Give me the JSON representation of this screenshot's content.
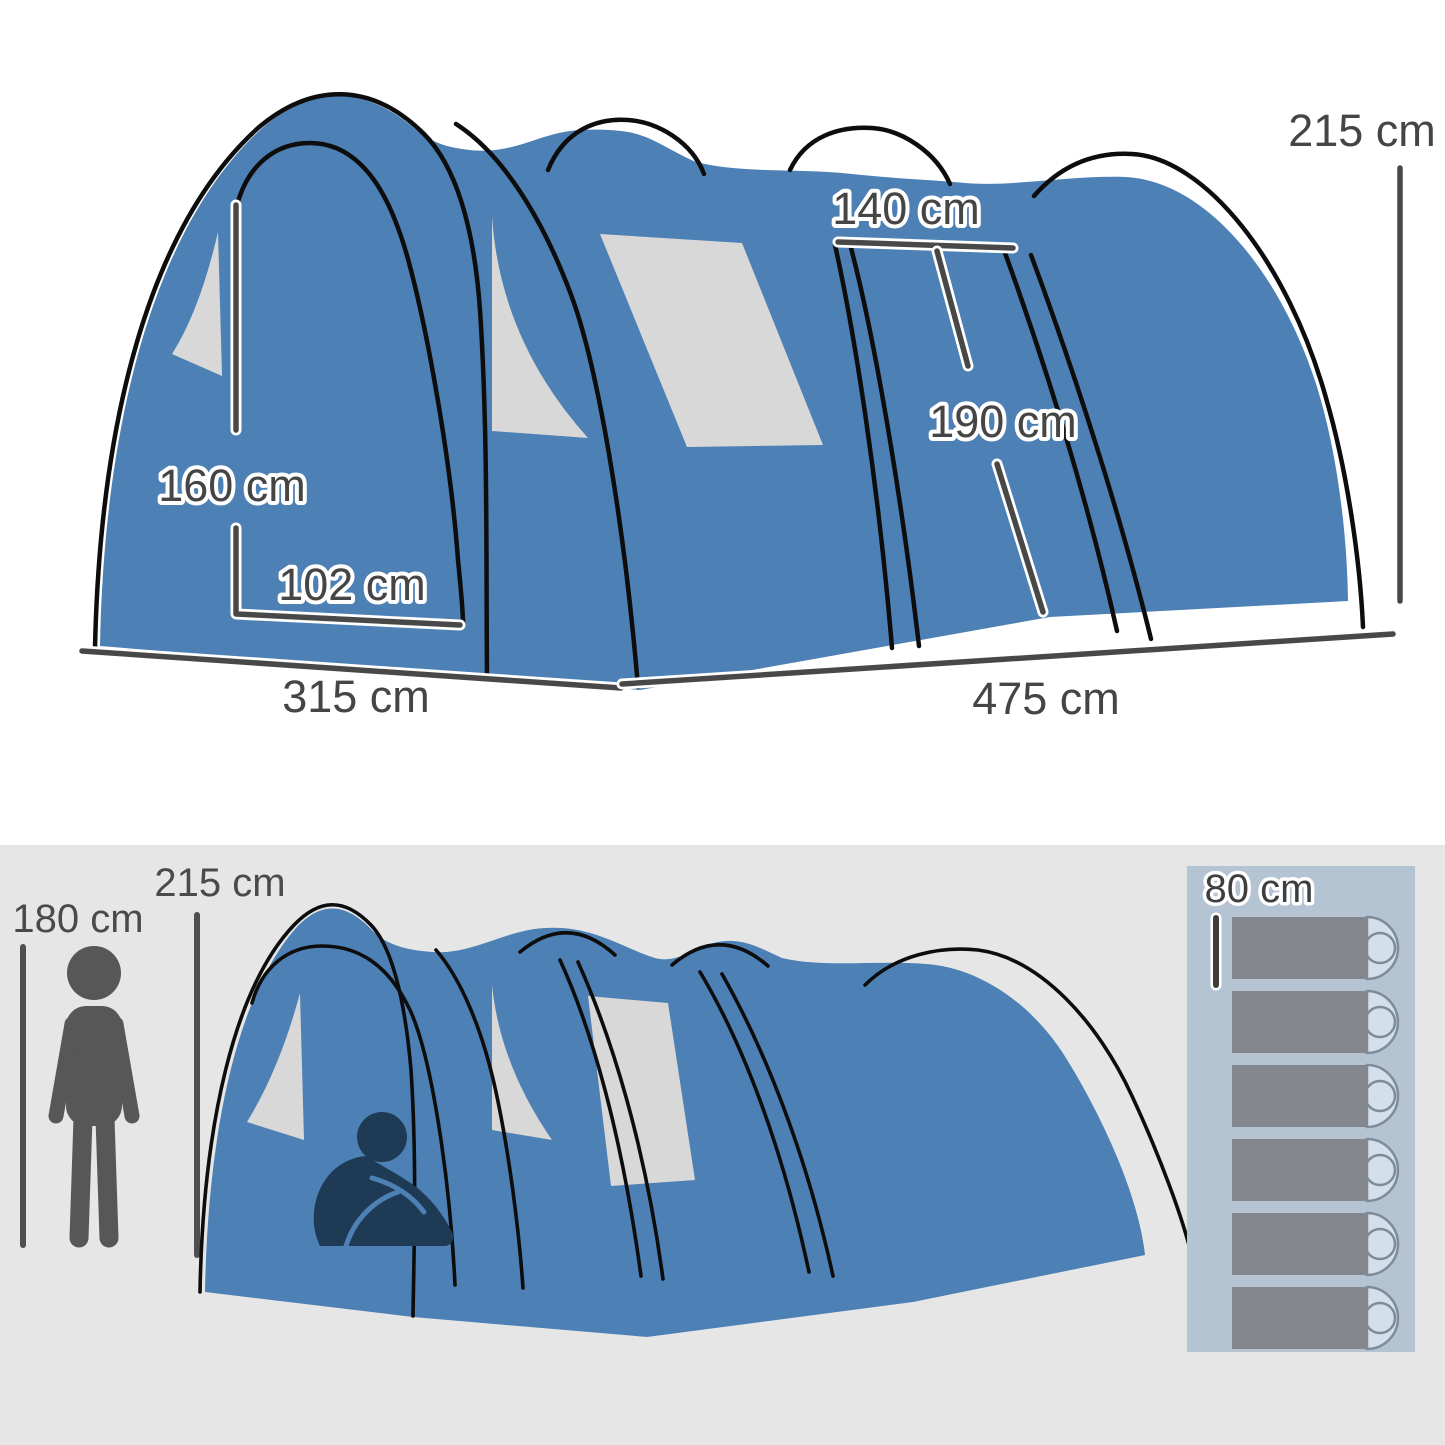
{
  "top_view": {
    "back_height": "215 cm",
    "inner_door_width": "140 cm",
    "inner_door_height": "190 cm",
    "front_door_height": "160 cm",
    "front_door_width": "102 cm",
    "front_width": "315 cm",
    "side_length": "475 cm"
  },
  "bottom_view": {
    "person_height": "180 cm",
    "tent_height": "215 cm",
    "sleeping_bag_width": "80 cm",
    "sleeping_bag_count": 6
  },
  "colors": {
    "tent_blue": "#4d80b4",
    "window_gray": "#d8d8d8",
    "outline_black": "#0d0d0d",
    "dimension_gray": "#484848",
    "label_text": "#454545",
    "upper_background": "#ffffff",
    "lower_background": "#e6e6e6",
    "figure_gray": "#575757",
    "sitting_person_navy": "#1e3a54",
    "mat_panel": "#b5c4d3",
    "sleeping_bag": "#84878d",
    "pillow": "#d3dfea"
  }
}
